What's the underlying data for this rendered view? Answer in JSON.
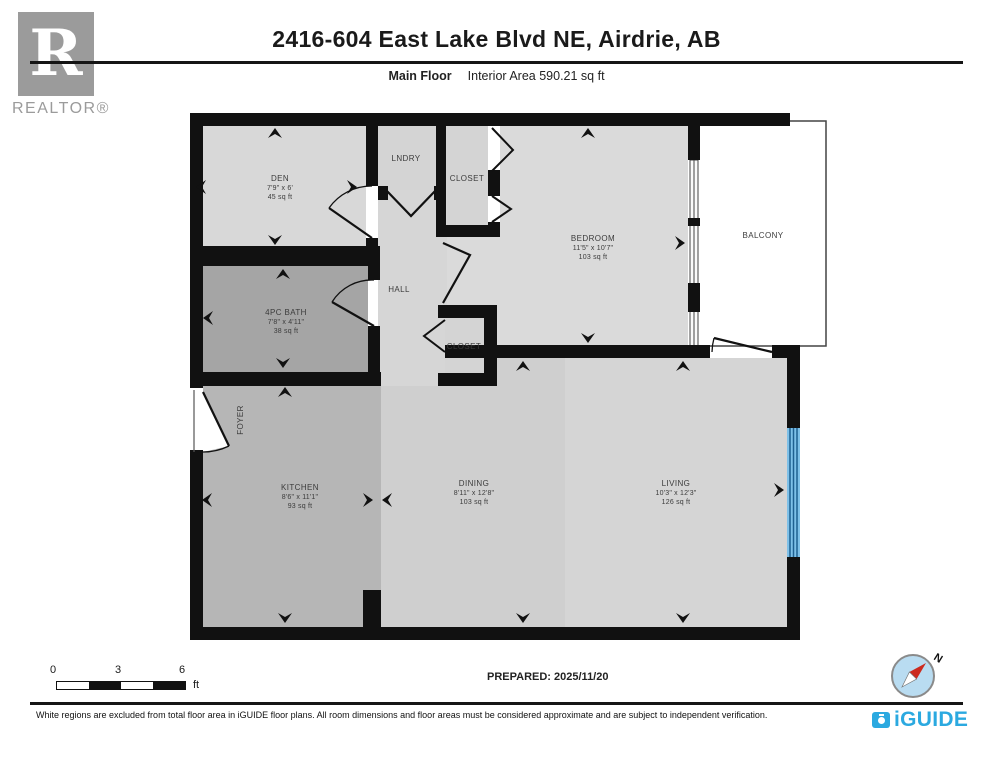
{
  "header": {
    "title": "2416-604 East Lake Blvd NE, Airdrie, AB",
    "floor_label": "Main Floor",
    "area_label": "Interior Area 590.21 sq ft",
    "realtor_logo": {
      "letter": "R",
      "label": "REALTOR®"
    }
  },
  "rooms": {
    "den": {
      "name": "DEN",
      "dims": "7'9\" x 6'",
      "area": "45 sq ft"
    },
    "lndry": {
      "name": "LNDRY"
    },
    "closet1": {
      "name": "CLOSET"
    },
    "bedroom": {
      "name": "BEDROOM",
      "dims": "11'5\" x 10'7\"",
      "area": "103 sq ft"
    },
    "balcony": {
      "name": "BALCONY"
    },
    "bath": {
      "name": "4PC BATH",
      "dims": "7'8\" x 4'11\"",
      "area": "38 sq ft"
    },
    "hall": {
      "name": "HALL"
    },
    "closet2": {
      "name": "CLOSET"
    },
    "foyer": {
      "name": "FOYER"
    },
    "kitchen": {
      "name": "KITCHEN",
      "dims": "8'6\" x 11'1\"",
      "area": "93 sq ft"
    },
    "dining": {
      "name": "DINING",
      "dims": "8'11\" x 12'8\"",
      "area": "103 sq ft"
    },
    "living": {
      "name": "LIVING",
      "dims": "10'3\" x 12'3\"",
      "area": "126 sq ft"
    }
  },
  "footer": {
    "scale": {
      "tick0": "0",
      "tick1": "3",
      "tick2": "6",
      "unit": "ft"
    },
    "prepared": "PREPARED: 2025/11/20",
    "compass_north": "N",
    "disclaimer": "White regions are excluded from total floor area in iGUIDE floor plans. All room dimensions and floor areas must be considered approximate and are subject to independent verification.",
    "brand": "iGUIDE"
  },
  "colors": {
    "wall": "#111111",
    "room_light": "#d8d8d8",
    "room_kitchen": "#b6b6b6",
    "room_bath": "#a5a5a5",
    "window_blue": "#7ec0e8",
    "window_stripe": "#1f6090",
    "brand_blue": "#2BA9E0",
    "logo_gray": "#9b9b9b",
    "compass_fill": "#b9dcf1",
    "needle_red": "#cc2a1e"
  }
}
